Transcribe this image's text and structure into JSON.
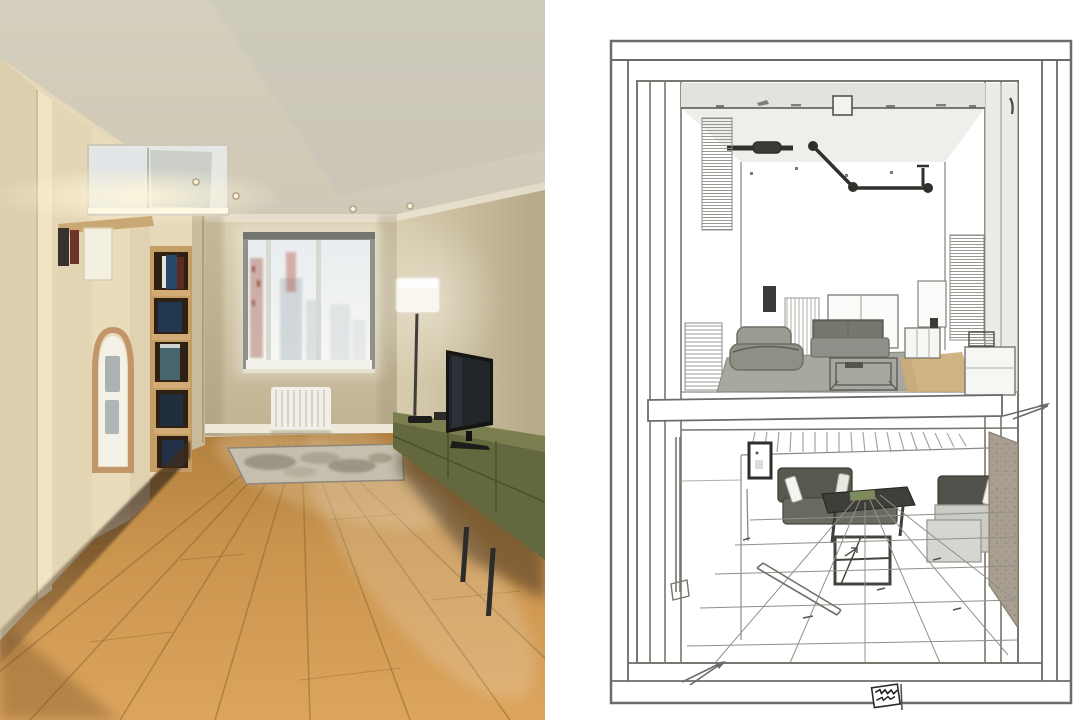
{
  "composition": {
    "kind": "side-by-side interior image",
    "left_panel": {
      "kind": "photorealistic-render",
      "visible_objects": [
        "beige ceiling with recessed spotlights",
        "cream built-in wardrobe with cove lighting",
        "mirrored floating cabinet",
        "open bookshelf with books",
        "arched frosted-glass door panel",
        "window with hazy city view",
        "white radiator",
        "floor lamp with white shade",
        "flat-screen tv on olive media console",
        "patterned area rug",
        "warm wood plank floor"
      ]
    },
    "right_panel": {
      "kind": "pencil-line-sketch",
      "visible_objects": [
        "double-line drawing border",
        "upper living-room perspective view with ceiling track light",
        "separating floor slab with leader arrow",
        "lower living-room perspective view with tiled floor",
        "leader arrow at bottom left",
        "illegible scribble stamp"
      ],
      "stamp": "illegible-scribble"
    }
  },
  "palette": {
    "wall_beige": "#cfc3a4",
    "ceiling_beige": "#d4cfc4",
    "cabinet_cream": "#e6d9ba",
    "shelf_wood": "#c59e66",
    "shelf_interior_dark": "#2e2013",
    "console_olive_front": "#64683e",
    "console_olive_top": "#7b7f50",
    "tv_black": "#151514",
    "rug_base": "#c6bfae",
    "lamp_shade": "#f8f6ef",
    "radiator_white": "#f1efe8",
    "sketch_line": "#6b6b6b",
    "sketch_line_dark": "#3e3e3a",
    "sketch_sofa_gray": "#8f8f86",
    "sketch_sofa_dark": "#59584f",
    "sketch_rug_gray": "#a8a8a0",
    "sketch_floor_tan": "#cdab77",
    "sketch_wall_texture": "#a89f90",
    "sketch_sectional_light": "#cbcbc5"
  }
}
